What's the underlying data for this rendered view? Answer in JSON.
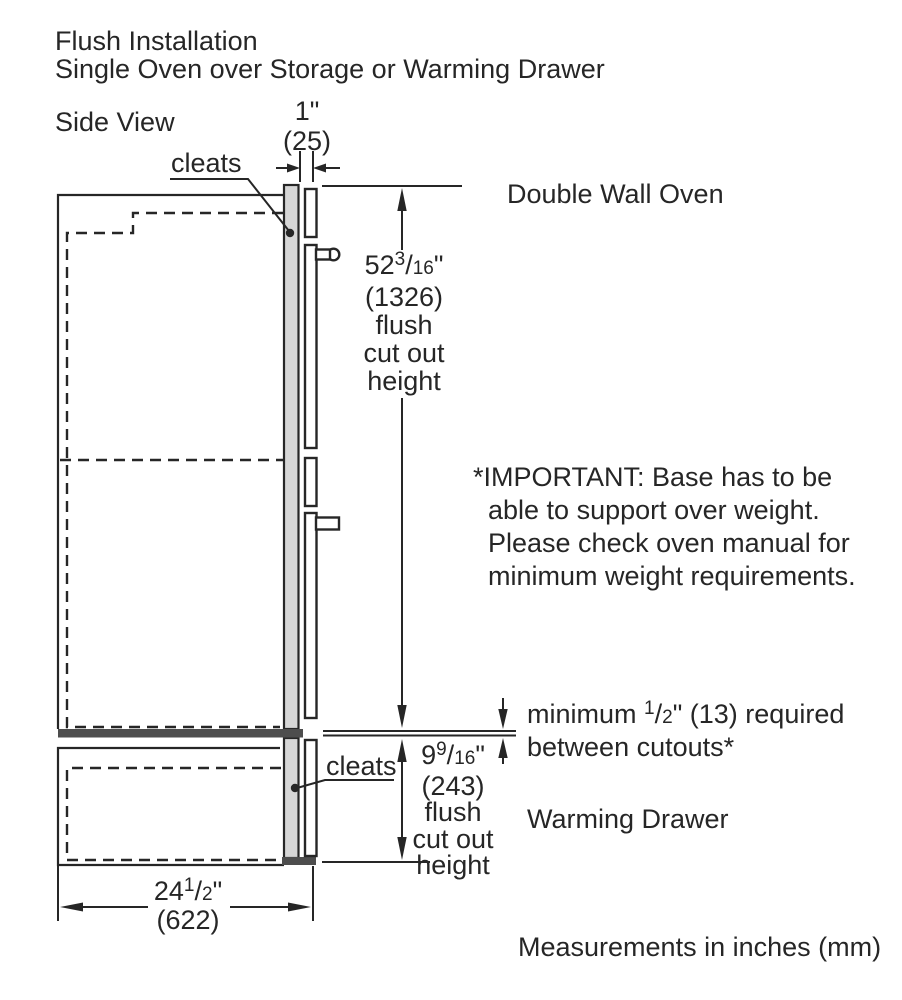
{
  "title": {
    "line1": "Flush Installation",
    "line2": "Single Oven over Storage or Warming Drawer"
  },
  "side_view_label": "Side View",
  "labels": {
    "cleats_top": "cleats",
    "cleats_bottom": "cleats",
    "double_wall_oven": "Double Wall Oven",
    "warming_drawer": "Warming Drawer"
  },
  "dimensions": {
    "cleat_depth": {
      "inches": "1\"",
      "mm": "(25)"
    },
    "oven_cutout": {
      "whole": "52",
      "sup": "3",
      "sep": "/",
      "den": "16",
      "unit": "\"",
      "mm": "(1326)",
      "desc1": "flush",
      "desc2": "cut out",
      "desc3": "height"
    },
    "drawer_cutout": {
      "whole": "9",
      "sup": "9",
      "sep": "/",
      "den": "16",
      "unit": "\"",
      "mm": "(243)",
      "desc1": "flush",
      "desc2": "cut out",
      "desc3": "height"
    },
    "cabinet_width": {
      "whole": "24",
      "sup": "1",
      "sep": "/",
      "den": "2",
      "unit": "\"",
      "mm": "(622)"
    },
    "min_gap": {
      "pre": "minimum ",
      "sup": "1",
      "sep": "/",
      "den": "2",
      "post": "\" (13) required",
      "line2": "between cutouts*"
    }
  },
  "important_note": {
    "line1": "*IMPORTANT: Base has to be",
    "line2": "able to support over weight.",
    "line3": "Please check oven manual for",
    "line4": "minimum weight requirements."
  },
  "footer": "Measurements in inches (mm)",
  "colors": {
    "line": "#262626",
    "panel_fill": "#d6d6d6",
    "separator_fill": "#4d4d4d",
    "background": "#ffffff"
  }
}
